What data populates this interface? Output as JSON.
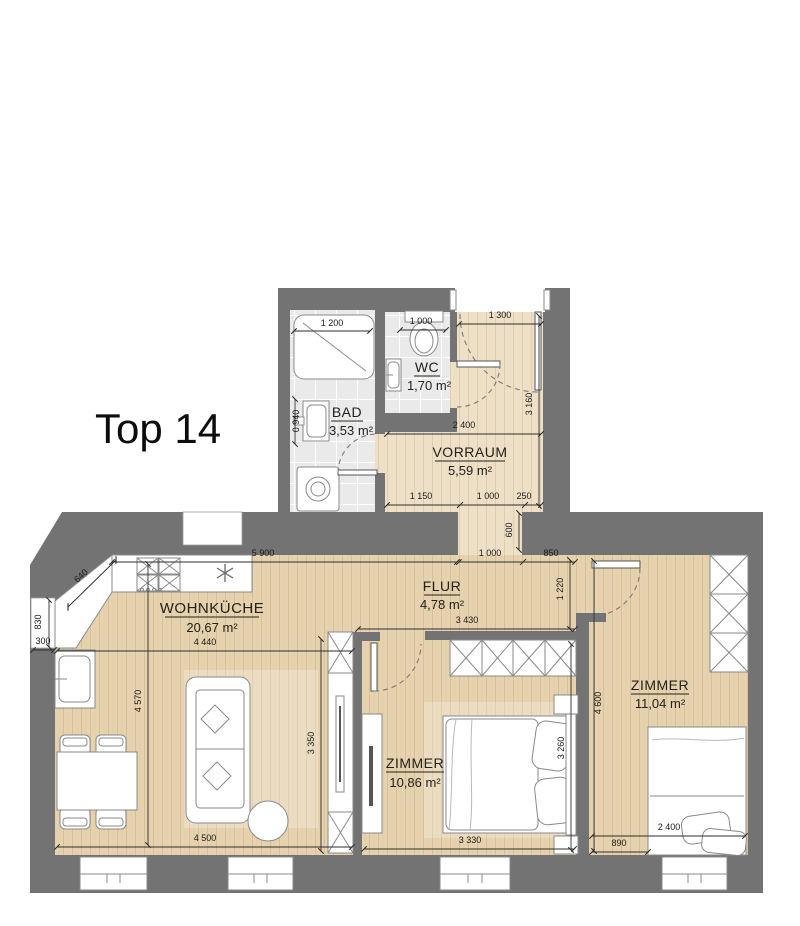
{
  "title": "Top 14",
  "rooms": {
    "wohnkueche": {
      "name": "WOHNKÜCHE",
      "area": "20,67 m²"
    },
    "flur": {
      "name": "FLUR",
      "area": "4,78 m²"
    },
    "vorraum": {
      "name": "VORRAUM",
      "area": "5,59 m²"
    },
    "bad": {
      "name": "BAD",
      "area": "3,53 m²"
    },
    "wc": {
      "name": "WC",
      "area": "1,70 m²"
    },
    "zimmer_mitte": {
      "name": "ZIMMER",
      "area": "10,86 m²"
    },
    "zimmer_rechts": {
      "name": "ZIMMER",
      "area": "11,04 m²"
    }
  },
  "dimensions": {
    "shower_width": "1 200",
    "bad_depth": "0 940",
    "wc_width": "1 000",
    "entry_door": "1 300",
    "vorraum_height": "3 160",
    "vorraum_width": "2 400",
    "corridor_1": "1 150",
    "corridor_2": "1 000",
    "corridor_3": "250",
    "wall_return": "600",
    "kitchen_top": "5 900",
    "corner_bevel": "640",
    "niche_height": "830",
    "niche_depth": "300",
    "kitchen_width": "4 440",
    "kitchen_depth": "4 570",
    "kitchen_bottom": "4 500",
    "kitchen_right": "3 350",
    "flur_top_1": "1 000",
    "flur_top_2": "850",
    "flur_right": "1 220",
    "flur_bottom": "3 430",
    "zimmer2_depth": "4 600",
    "zimmer1_bottom": "3 330",
    "zimmer1_right": "3 260",
    "zimmer2_left": "890",
    "zimmer2_bottom": "2 400"
  },
  "colors": {
    "wall": "#737373",
    "wood": "#e6d2ae",
    "wood_light": "#eedfc7",
    "tile": "#eaeaea",
    "fixture_outline": "#8a8a8a",
    "dimension_line": "#2e2e2e",
    "label_text": "#23211c"
  }
}
